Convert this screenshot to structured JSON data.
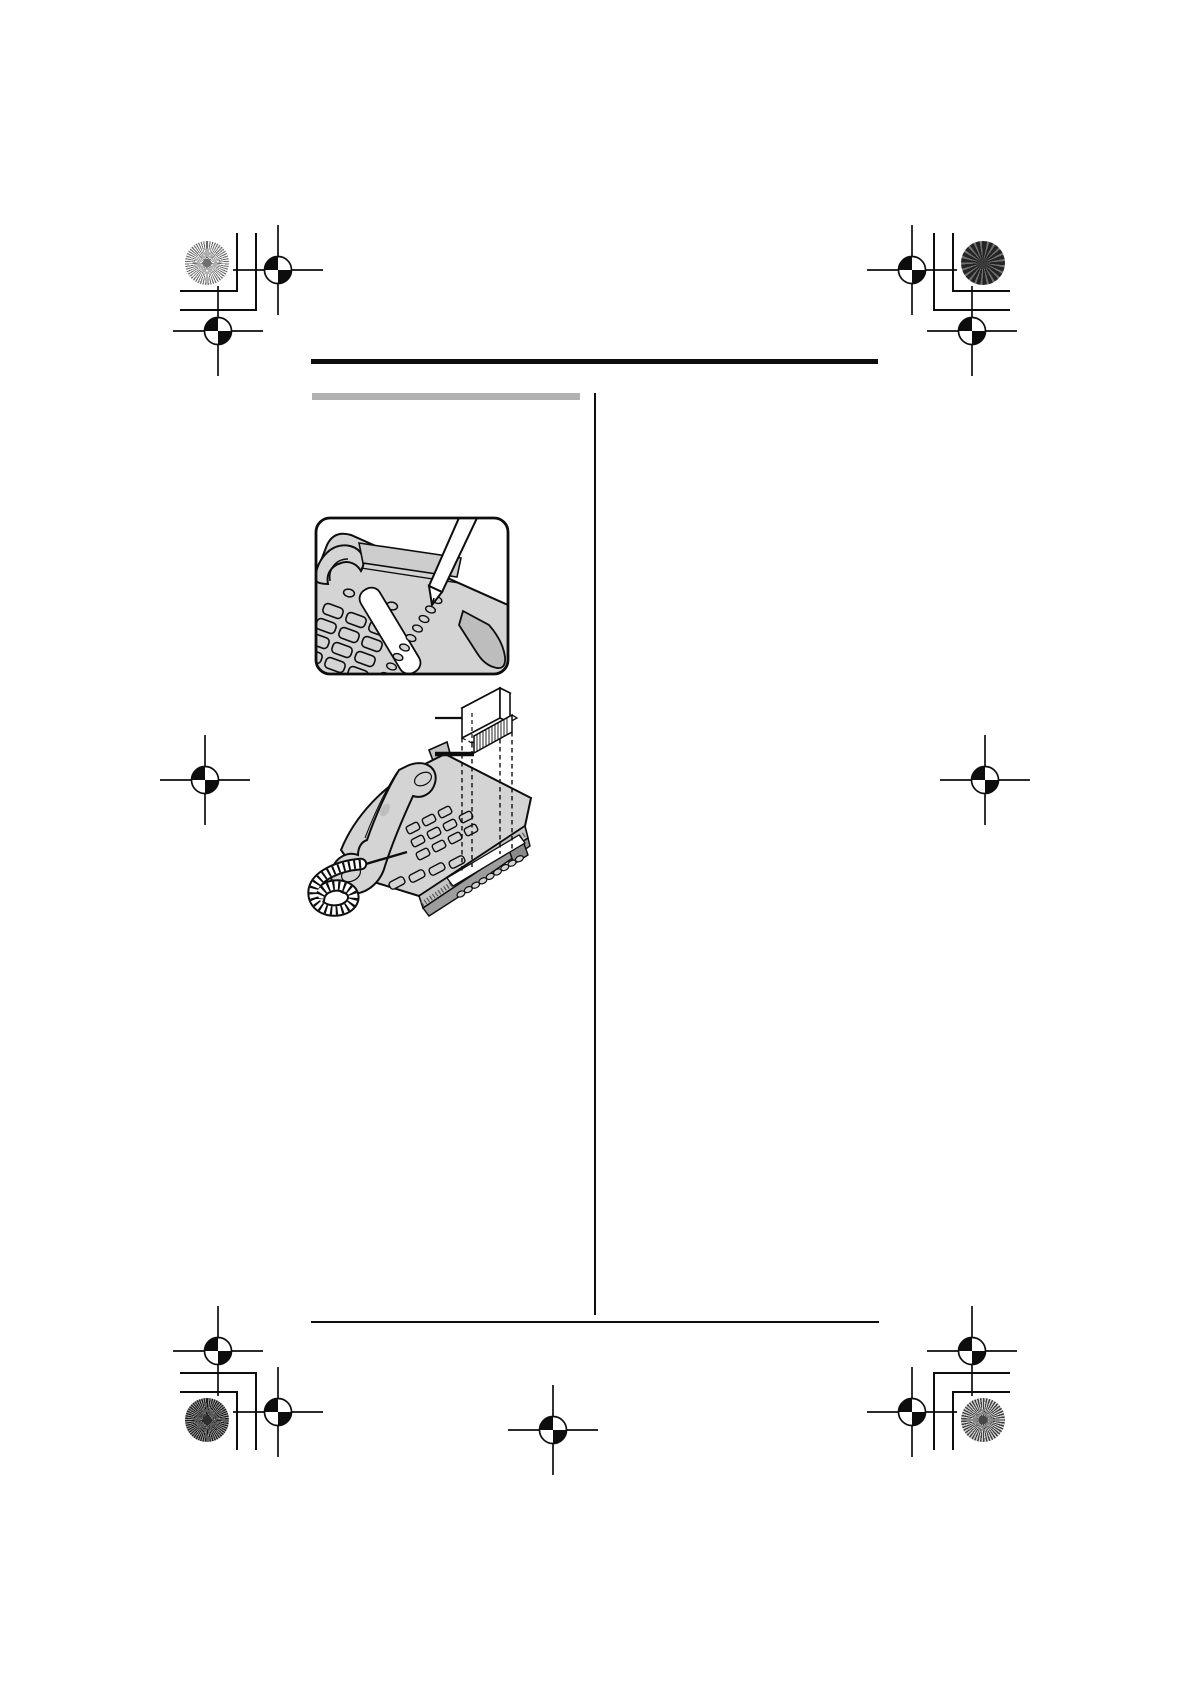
{
  "document": {
    "kind": "print-production proof page of an instruction manual; all body text is blank/masked, only rules, figures and prepress marks are visible",
    "page_width_px": 1190,
    "page_height_px": 1684
  },
  "colors": {
    "paper": "#ffffff",
    "ink": "#0d0d0d",
    "section-bar": "#b1b1b3",
    "phone": "#d4d4d4",
    "phone-side": "#c4c4c4",
    "phone-base": "#9d9d9d",
    "panel": "#cdcdcd",
    "foot": "#bdbdbd",
    "white": "#ffffff"
  },
  "prepress": {
    "registration_mark_icon": "circle-crosshair-target",
    "star_target_icon": "pinwheel-star-circle",
    "trim_bracket_icon": "corner-trim-lines",
    "mark_positions": [
      "top-left",
      "top-right",
      "middle-left",
      "middle-right",
      "bottom-left",
      "bottom-center",
      "bottom-right"
    ]
  },
  "layout": {
    "header-rule": {
      "x": 311,
      "y": 359,
      "width": 567,
      "height": 4.5
    },
    "section-title-bar": {
      "x": 312,
      "y": 393,
      "width": 268,
      "height": 7
    },
    "column-divider": {
      "x": 594,
      "y": 393,
      "width": 2,
      "height": 922
    },
    "footer-rule": {
      "x": 311,
      "y": 1321,
      "width": 568,
      "height": 2
    }
  },
  "content": {
    "section_title_bar_note": "solid gray bar where the section heading would print; no readable characters",
    "left_column": {
      "figures": [
        {
          "depicts": "Close-up inside a rounded-corner frame: a pen writes on the white station label strip of a desk telephone, beside a column of small oval one-touch buttons and the dial keypad."
        },
        {
          "depicts": "Corded desk telephone with handset and coiled cord; exploded view above shows the transparent label cover and ruled label strip, dashed projection lines dropping to the one-touch button row, a thin leader line to the cover and a thick leader line to the strip."
        }
      ]
    },
    "right_column": {
      "text_blocks": []
    }
  }
}
